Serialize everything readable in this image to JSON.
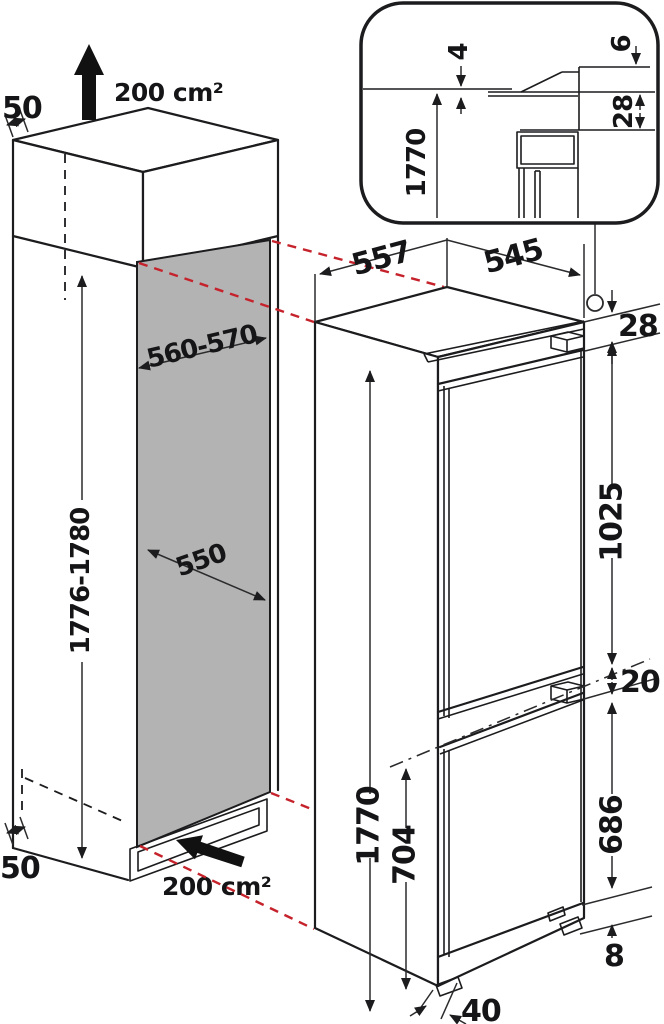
{
  "diagram": {
    "niche": {
      "top_clearance": "50",
      "top_vent_area": "200 cm²",
      "width": "560-570",
      "height": "1776-1780",
      "depth": "550",
      "bottom_clearance": "50",
      "bottom_vent_area": "200 cm²"
    },
    "appliance": {
      "depth_with_door": "557",
      "body_depth": "545",
      "top_gap": "28",
      "upper_door_height": "1025",
      "door_gap": "20",
      "lower_door_height": "686",
      "base_height": "8",
      "foot_offset": "40",
      "total_height": "1770",
      "lower_section_height": "704"
    },
    "detail_inset": {
      "top_clearance": "4",
      "grille_height": "6",
      "top_offset": "28",
      "appliance_height": "1770"
    },
    "colors": {
      "line": "#1c1c1e",
      "projection_red": "#c5222b",
      "panel_gray": "#b3b3b3"
    }
  }
}
